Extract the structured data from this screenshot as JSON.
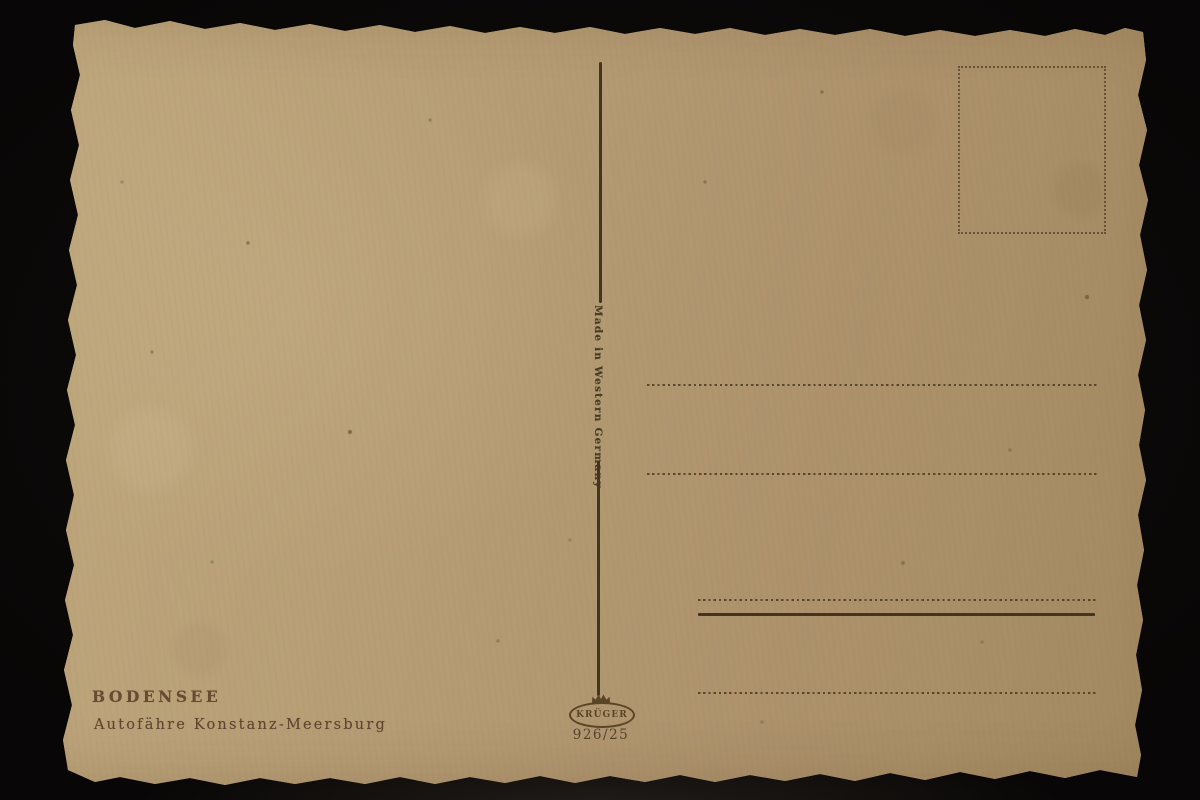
{
  "scene": {
    "background_color": "#0b0908"
  },
  "postcard": {
    "paper_color": "#b49b73",
    "ink_color": "#4b3b25",
    "caption": {
      "title": "BODENSEE",
      "subtitle": "Autofähre Konstanz-Meersburg"
    },
    "divider_text": "Made in Western Germany",
    "publisher": {
      "name": "KRÜGER",
      "series_number": "926/25",
      "logo_icon": "crown-icon"
    },
    "stamp_box_border": "dotted",
    "address_line_style": "dotted"
  }
}
